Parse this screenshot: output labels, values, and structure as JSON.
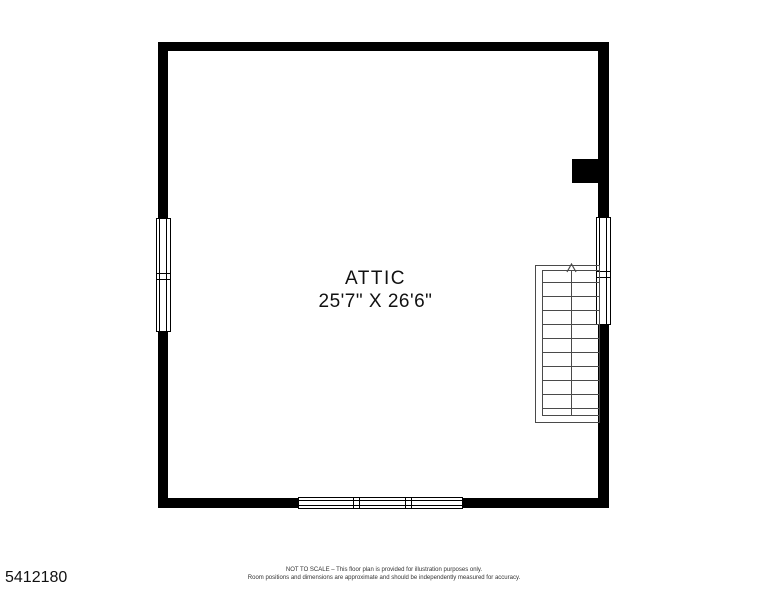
{
  "page": {
    "background_color": "#ffffff",
    "wall_color": "#000000"
  },
  "floor_plan": {
    "room": {
      "name": "ATTIC",
      "dimensions": "25'7\" X 26'6\""
    },
    "stairs": {
      "tread_lines": 10,
      "direction": "up"
    }
  },
  "footer": {
    "listing_id": "5412180",
    "disclaimer_line1": "NOT TO SCALE – This floor plan is provided for illustration purposes only.",
    "disclaimer_line2": "Room positions and dimensions are approximate and should be independently measured for accuracy."
  }
}
